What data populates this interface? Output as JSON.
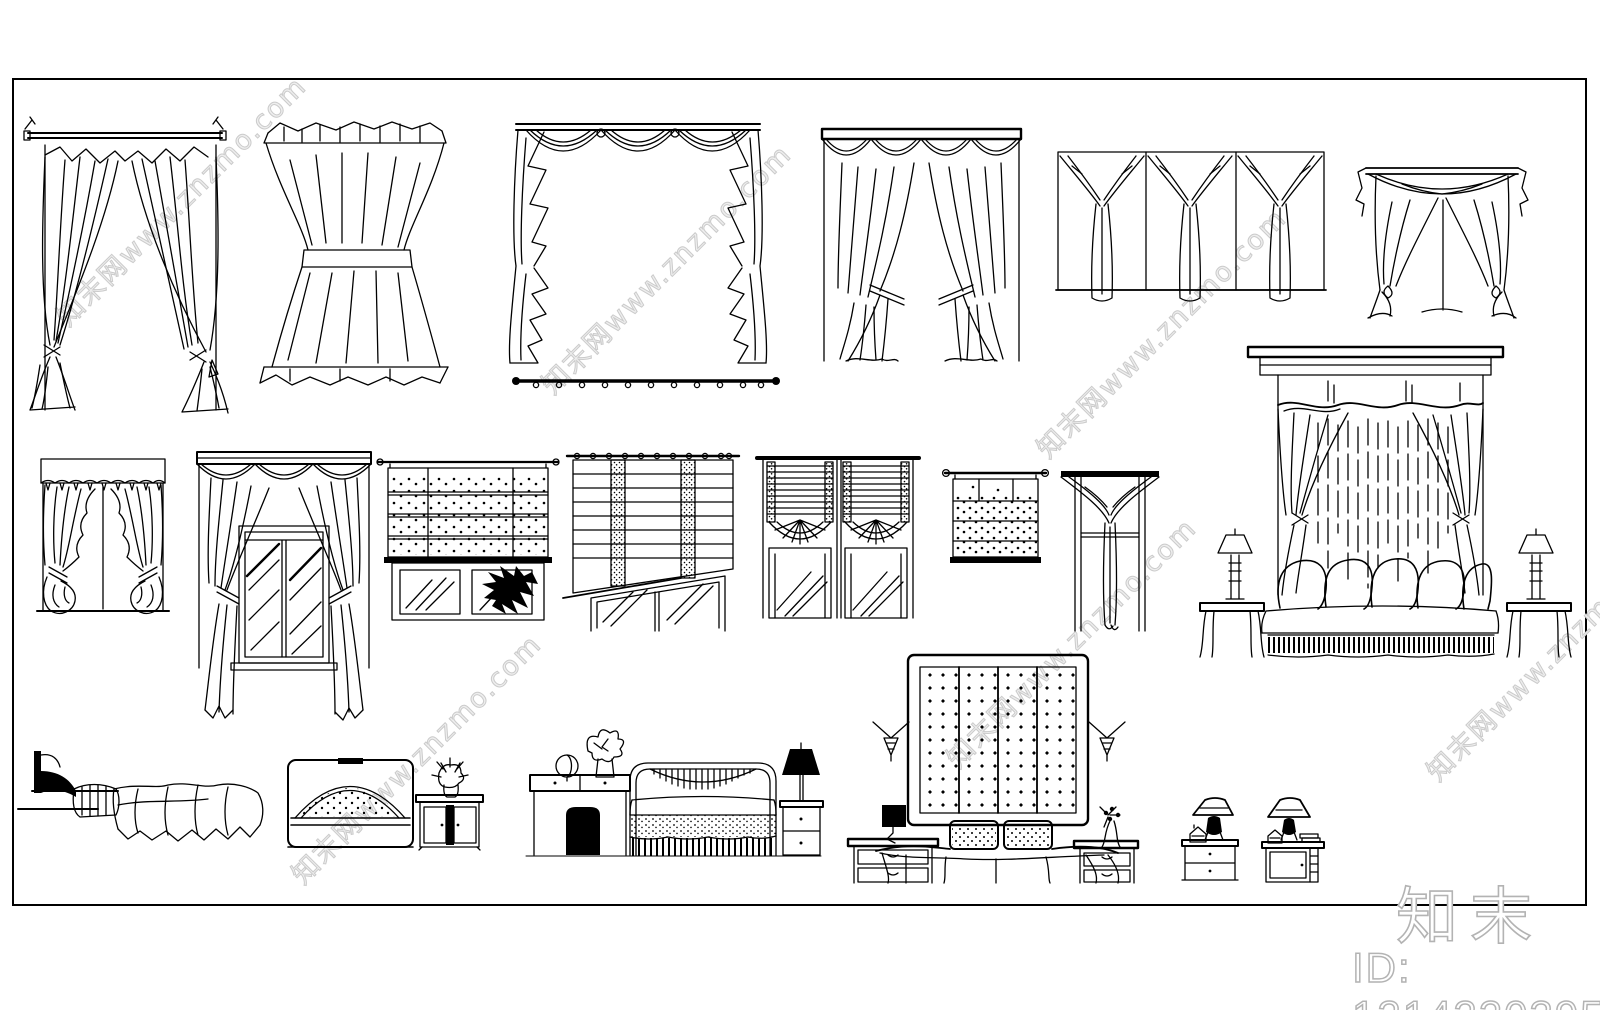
{
  "page": {
    "background": "#ffffff",
    "line_color": "#000000"
  },
  "watermark": {
    "diagonal_text": "知末网www.znzmo.com",
    "logo_text": "知末",
    "id_text": "ID: 1214220395",
    "diagonal_color": "#cbcbcb",
    "logo_color": "#b3b3b3"
  },
  "blocks": [
    {
      "name": "pole-canopy-drapes"
    },
    {
      "name": "hourglass-sash-curtain"
    },
    {
      "name": "swag-valance-with-cascades"
    },
    {
      "name": "curtain-rod-with-rings"
    },
    {
      "name": "cornice-scallop-curtains"
    },
    {
      "name": "three-panel-draped-valance"
    },
    {
      "name": "scarf-swag-curtain"
    },
    {
      "name": "canopy-bed-with-drapery-and-lamps"
    },
    {
      "name": "ruffled-cottage-curtain"
    },
    {
      "name": "valance-window-with-long-drapes"
    },
    {
      "name": "dotted-roman-shade-window"
    },
    {
      "name": "banded-roman-shade-window"
    },
    {
      "name": "balloon-shade-window"
    },
    {
      "name": "dotted-mini-shade"
    },
    {
      "name": "scarf-tail-window"
    },
    {
      "name": "bed-side-elevation"
    },
    {
      "name": "arched-headboard-with-nightstand"
    },
    {
      "name": "vanity-bed-nightstand-set"
    },
    {
      "name": "panel-headboard-bed-set"
    },
    {
      "name": "pair-of-nightstands-with-lamps"
    }
  ]
}
